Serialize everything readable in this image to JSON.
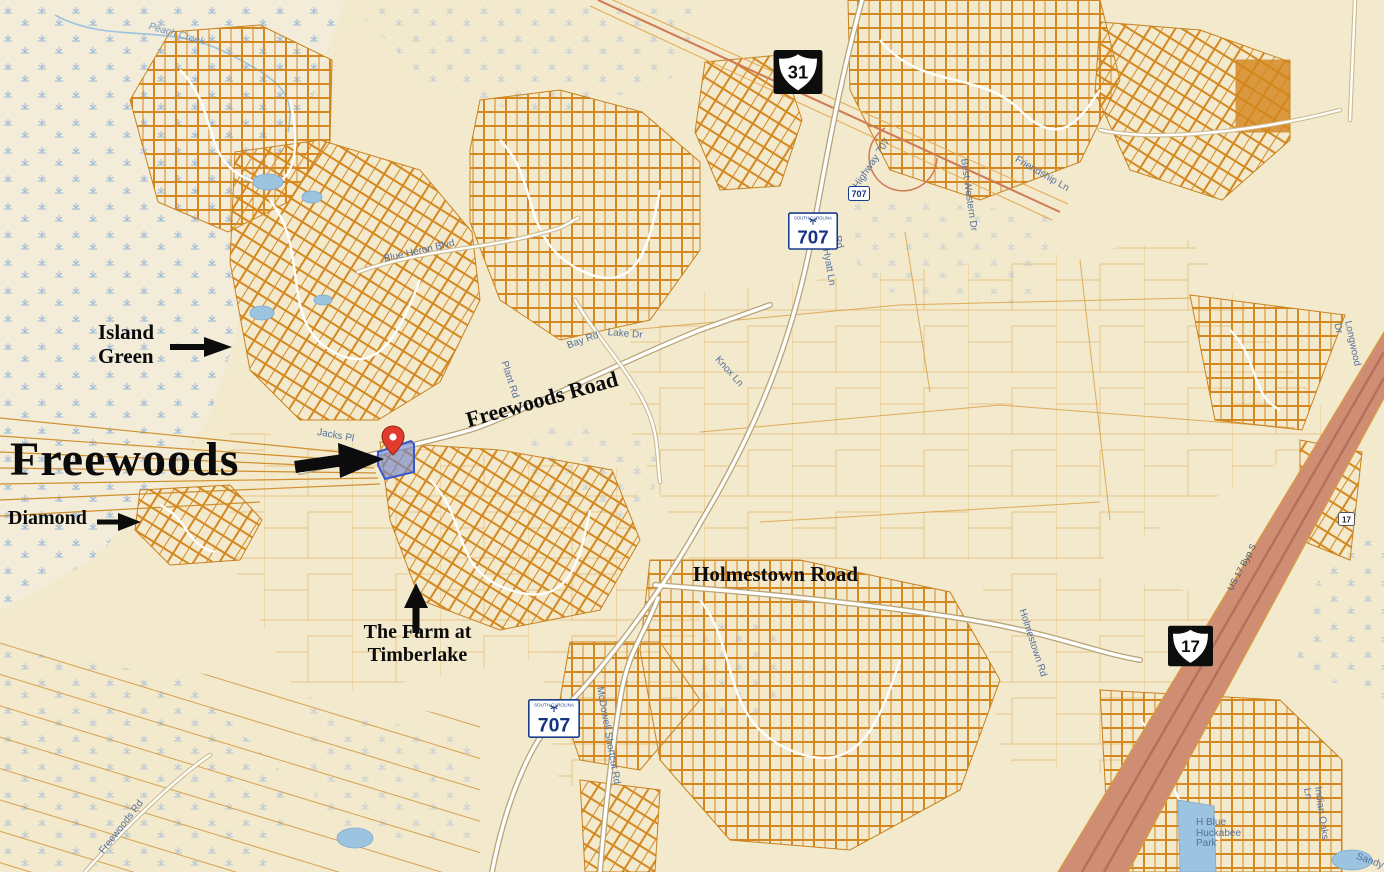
{
  "map": {
    "annotations": {
      "freewoods": "Freewoods",
      "island_green": "Island\nGreen",
      "diamond": "Diamond",
      "farm": "The Farm at\nTimberlake",
      "freewoods_road": "Freewoods Road",
      "holmestown_road": "Holmestown Road"
    },
    "shields": {
      "us31": "31",
      "us17": "17",
      "sc707_north": "707",
      "sc707_south": "707",
      "sc707_small": "707",
      "us17_small": "17",
      "state_header": "SOUTH CAROLINA"
    },
    "streets": [
      {
        "text": "Peach Creek"
      },
      {
        "text": "Blue Heron Blvd"
      },
      {
        "text": "Bay Rd"
      },
      {
        "text": "Plant Rd"
      },
      {
        "text": "Jacks Pl"
      },
      {
        "text": "Lake Dr"
      },
      {
        "text": "Knox Ln"
      },
      {
        "text": "Lee Rd"
      },
      {
        "text": "Hyatt Ln"
      },
      {
        "text": "Highway 707"
      },
      {
        "text": "Friendship Ln"
      },
      {
        "text": "Best Western Dr"
      },
      {
        "text": "US 17 Byp S"
      },
      {
        "text": "McDowell Shortcut Rd"
      },
      {
        "text": "Holmestown Rd"
      },
      {
        "text": "Freewoods Rd"
      },
      {
        "text": "H Blue\nHuckabee\nPark"
      },
      {
        "text": "Indian Oaks Ln"
      },
      {
        "text": "Sandy"
      },
      {
        "text": "Longwood Dr"
      }
    ],
    "marker": {
      "label": "subject-property-pin",
      "color": "#e23b2e"
    },
    "highlight_parcel": {
      "fill": "#6e84d0",
      "stroke": "#3a57c9"
    },
    "colors": {
      "background": "#f3e9cd",
      "parcel_orange": "#d4881f",
      "wetland_blue": "#8ab0d8",
      "road_white": "#ffffff",
      "us17_band": "#cf8d74",
      "annotation_black": "#0b0b0b",
      "street_label_blue": "#53719f"
    }
  }
}
